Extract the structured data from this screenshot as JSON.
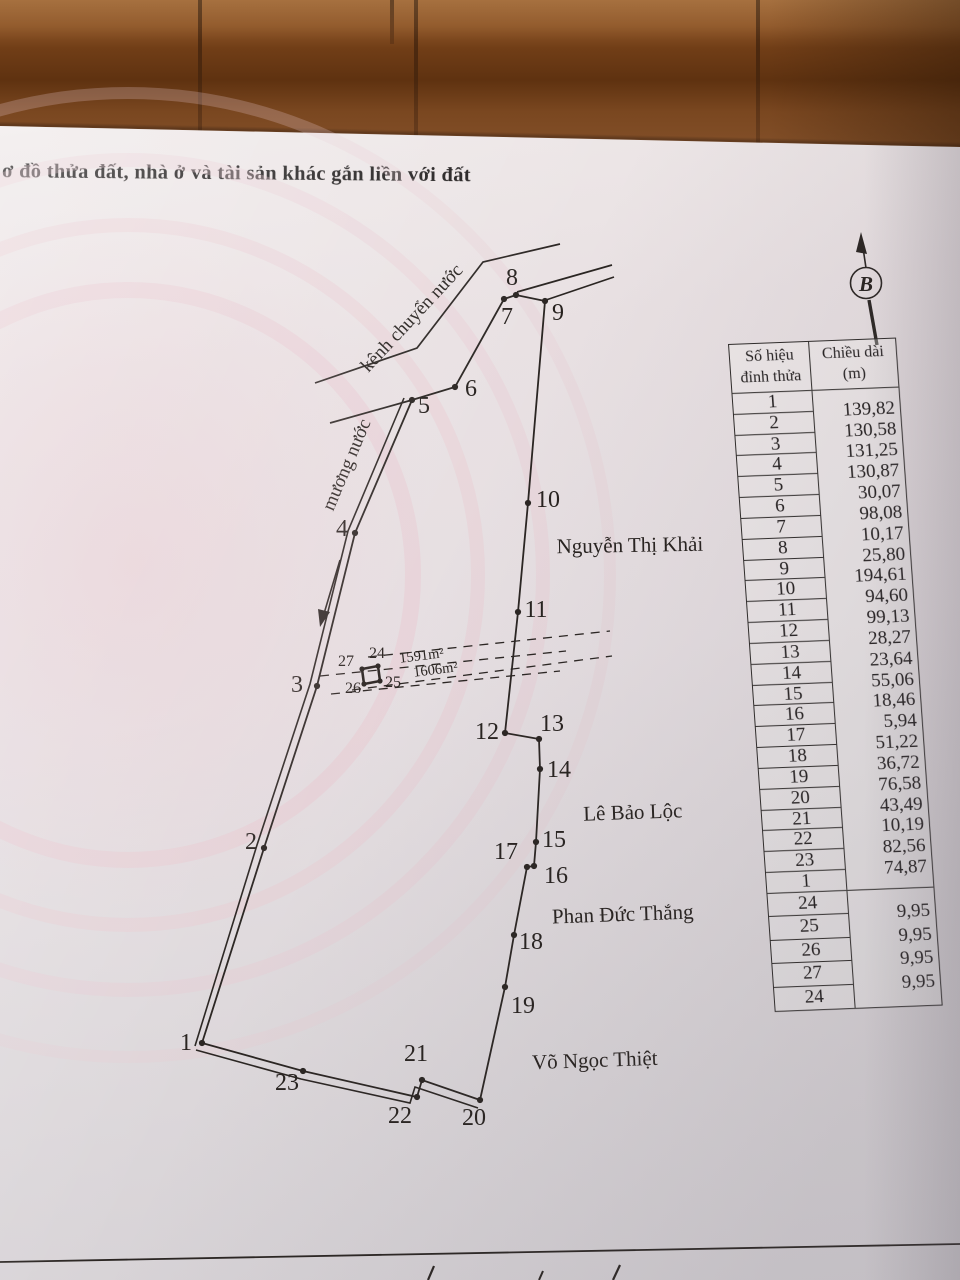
{
  "title": "ơ đồ thửa đất, nhà ở và tài sản khác gắn liền với đất",
  "north": {
    "symbol": "B"
  },
  "table": {
    "header": {
      "col1_line1": "Số hiệu",
      "col1_line2": "đỉnh thửa",
      "col2_line1": "Chiều dài",
      "col2_line2": "(m)"
    },
    "section1": {
      "vertex_labels": [
        "1",
        "2",
        "3",
        "4",
        "5",
        "6",
        "7",
        "8",
        "9",
        "10",
        "11",
        "12",
        "13",
        "14",
        "15",
        "16",
        "17",
        "18",
        "19",
        "20",
        "21",
        "22",
        "23",
        "1"
      ],
      "lengths": [
        "139,82",
        "130,58",
        "131,25",
        "130,87",
        "30,07",
        "98,08",
        "10,17",
        "25,80",
        "194,61",
        "94,60",
        "99,13",
        "28,27",
        "23,64",
        "55,06",
        "18,46",
        "5,94",
        "51,22",
        "36,72",
        "76,58",
        "43,49",
        "10,19",
        "82,56",
        "74,87"
      ]
    },
    "section2": {
      "vertex_labels": [
        "24",
        "25",
        "26",
        "27",
        "24"
      ],
      "lengths": [
        "9,95",
        "9,95",
        "9,95",
        "9,95"
      ]
    }
  },
  "diagram": {
    "ink": "#2a2522",
    "vertices": [
      {
        "n": "1",
        "x": 202,
        "y": 1043,
        "lx": 186,
        "ly": 1050
      },
      {
        "n": "2",
        "x": 264,
        "y": 848,
        "lx": 251,
        "ly": 849
      },
      {
        "n": "3",
        "x": 317,
        "y": 686,
        "lx": 297,
        "ly": 692
      },
      {
        "n": "4",
        "x": 355,
        "y": 533,
        "lx": 342,
        "ly": 536
      },
      {
        "n": "5",
        "x": 412,
        "y": 400,
        "lx": 424,
        "ly": 413
      },
      {
        "n": "6",
        "x": 455,
        "y": 387,
        "lx": 471,
        "ly": 396
      },
      {
        "n": "7",
        "x": 504,
        "y": 299,
        "lx": 507,
        "ly": 324
      },
      {
        "n": "8",
        "x": 516,
        "y": 295,
        "lx": 512,
        "ly": 285
      },
      {
        "n": "9",
        "x": 545,
        "y": 301,
        "lx": 558,
        "ly": 320
      },
      {
        "n": "10",
        "x": 528,
        "y": 503,
        "lx": 548,
        "ly": 507
      },
      {
        "n": "11",
        "x": 518,
        "y": 612,
        "lx": 536,
        "ly": 617
      },
      {
        "n": "12",
        "x": 505,
        "y": 733,
        "lx": 487,
        "ly": 739
      },
      {
        "n": "13",
        "x": 539,
        "y": 739,
        "lx": 552,
        "ly": 731
      },
      {
        "n": "14",
        "x": 540,
        "y": 769,
        "lx": 559,
        "ly": 777
      },
      {
        "n": "15",
        "x": 536,
        "y": 842,
        "lx": 554,
        "ly": 847
      },
      {
        "n": "16",
        "x": 534,
        "y": 866,
        "lx": 556,
        "ly": 883
      },
      {
        "n": "17",
        "x": 527,
        "y": 867,
        "lx": 506,
        "ly": 859
      },
      {
        "n": "18",
        "x": 514,
        "y": 935,
        "lx": 531,
        "ly": 949
      },
      {
        "n": "19",
        "x": 505,
        "y": 987,
        "lx": 523,
        "ly": 1013
      },
      {
        "n": "20",
        "x": 480,
        "y": 1100,
        "lx": 474,
        "ly": 1125
      },
      {
        "n": "21",
        "x": 422,
        "y": 1080,
        "lx": 416,
        "ly": 1061
      },
      {
        "n": "22",
        "x": 417,
        "y": 1097,
        "lx": 400,
        "ly": 1123
      },
      {
        "n": "23",
        "x": 303,
        "y": 1071,
        "lx": 287,
        "ly": 1090
      }
    ],
    "extra_dots": [
      [
        362,
        669
      ],
      [
        378,
        666
      ],
      [
        380,
        681
      ],
      [
        364,
        684
      ]
    ],
    "texts": [
      {
        "name": "inner-vertex-label-27",
        "t": "27",
        "x": 346,
        "y": 666,
        "s": 16
      },
      {
        "name": "inner-vertex-label-24",
        "t": "24",
        "x": 377,
        "y": 658,
        "s": 16
      },
      {
        "name": "inner-vertex-label-26",
        "t": "26",
        "x": 353,
        "y": 693,
        "s": 16
      },
      {
        "name": "inner-vertex-label-25",
        "t": "25",
        "x": 393,
        "y": 687,
        "s": 16
      },
      {
        "name": "area-label-1591",
        "t": "1591m²",
        "x": 422,
        "y": 660,
        "s": 14.5,
        "r": -7
      },
      {
        "name": "area-label-1606",
        "t": "1606m²",
        "x": 436,
        "y": 674,
        "s": 14.5,
        "r": -7
      },
      {
        "name": "canal-label",
        "t": "kênh chuyển nước",
        "x": 416,
        "y": 322,
        "s": 19,
        "r": -47
      },
      {
        "name": "ditch-label",
        "t": "mương nước",
        "x": 352,
        "y": 467,
        "s": 19,
        "r": -67
      },
      {
        "name": "neighbor-label-north",
        "t": "Nguyễn Thị Khải",
        "x": 630,
        "y": 552,
        "s": 21,
        "r": -1
      },
      {
        "name": "neighbor-label-mid",
        "t": "Lê Bảo Lộc",
        "x": 633,
        "y": 819,
        "s": 21,
        "r": -2
      },
      {
        "name": "neighbor-label-south1",
        "t": "Phan Đức Thắng",
        "x": 623,
        "y": 921,
        "s": 21,
        "r": -2
      },
      {
        "name": "neighbor-label-south2",
        "t": "Võ Ngọc Thiệt",
        "x": 595,
        "y": 1067,
        "s": 21,
        "r": -2
      },
      {
        "name": "north-symbol",
        "t": "B",
        "x": 866,
        "y": 291,
        "s": 21,
        "i": 1
      }
    ],
    "paths": [
      {
        "name": "boundary-right",
        "d": "M545,301 L528,503 L518,612 L505,733 L539,739 L540,769 L536,842 L534,866 L527,867 L514,935 L505,987 L480,1100",
        "w": 1.8
      },
      {
        "name": "boundary-left-inner",
        "d": "M202,1043 L264,848 L317,686 L355,533 L412,400",
        "w": 1.8
      },
      {
        "name": "boundary-left-outer",
        "d": "M195,1046 L257,845 L310,684 L348,531 L404,398",
        "w": 1.6
      },
      {
        "name": "boundary-top",
        "d": "M412,400 L455,387 L504,299 L516,295 L545,301",
        "w": 1.8
      },
      {
        "name": "boundary-bottom-inner",
        "d": "M202,1043 L303,1071 L417,1097 L422,1080 L480,1100",
        "w": 1.8
      },
      {
        "name": "boundary-bottom-outer",
        "d": "M196,1050 L301,1079 L410,1103 L415,1087 L478,1108",
        "w": 1.6
      },
      {
        "name": "canal-upper-line",
        "d": "M560,244 L483,262 L417,348 L315,383",
        "w": 1.7
      },
      {
        "name": "canal-lower-line",
        "d": "M330,423 L412,400",
        "w": 1.7
      },
      {
        "name": "canal-east-line-1",
        "d": "M517,292 L612,265",
        "w": 1.7
      },
      {
        "name": "canal-east-line-2",
        "d": "M546,300 L614,277",
        "w": 1.7
      },
      {
        "name": "flow-arrow-line",
        "d": "M340,560 L323,617",
        "w": 1.6
      },
      {
        "name": "flow-arrow-head",
        "d": "M320,627 L330,612 L318,609 Z",
        "fill": 1
      },
      {
        "name": "inner-square",
        "d": "M362,669 L378,666 L380,681 L364,684 Z",
        "w": 2.6
      },
      {
        "name": "north-arrow-shaft",
        "d": "M866,268 L862,241",
        "w": 1.6
      },
      {
        "name": "north-arrow-head",
        "d": "M861,232 L867,254 L856,252 Z",
        "fill": 1
      },
      {
        "name": "north-arrow-tail",
        "d": "M869,300 L877,345",
        "w": 3.4
      },
      {
        "name": "page-rule",
        "d": "M0,1262 L960,1244",
        "w": 1.8
      },
      {
        "name": "pen-mark-1",
        "d": "M428,1280 L434,1266",
        "w": 2.2
      },
      {
        "name": "pen-mark-2",
        "d": "M539,1280 L543,1271",
        "w": 2
      },
      {
        "name": "pen-mark-3",
        "d": "M613,1280 L620,1265",
        "w": 2.2
      }
    ],
    "dashed": [
      {
        "d": "M368,657 L610,631"
      },
      {
        "d": "M320,676 L566,651"
      },
      {
        "d": "M352,690 L612,656"
      },
      {
        "d": "M331,694 L560,671"
      }
    ],
    "north_circle": {
      "cx": 866,
      "cy": 283,
      "r": 15.5
    }
  }
}
